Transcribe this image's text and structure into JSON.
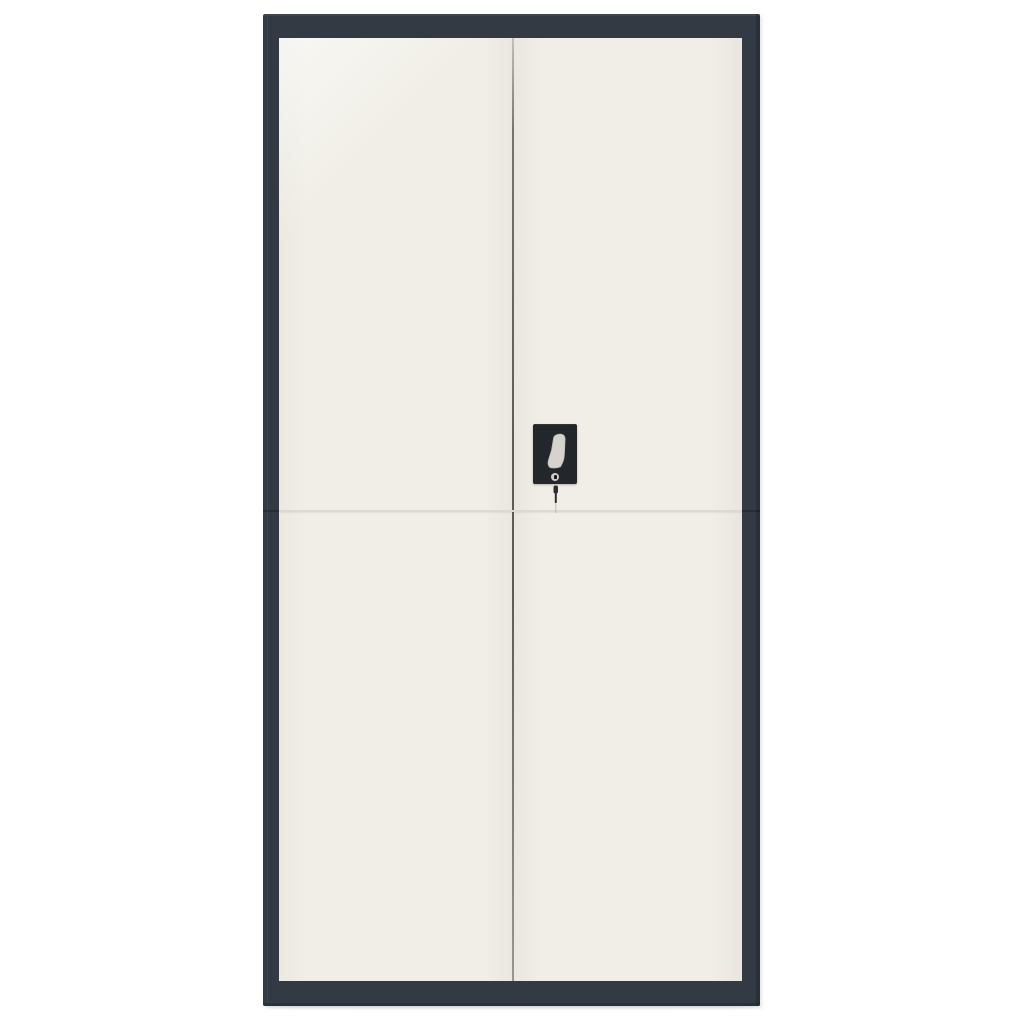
{
  "scene": {
    "subject": "Tall two-door steel file cabinet with anthracite frame, off-white doors, black lock plate with lever handle, keyhole and hanging key",
    "background_color": "#ffffff"
  },
  "colors": {
    "frame": "#333a43",
    "door": "#f0eee6",
    "seam_vertical_base": "#74736e",
    "seam_horizontal": "#dcd9d2",
    "handle_plate": "#23262b",
    "handle_lever": "#d6d3cc",
    "handle_lever_edge": "#bdbab2",
    "keyhole_ring": "#cfccc5",
    "keyhole_slot": "#16181c",
    "key": "#2b2e33",
    "key_cord": "#b4b1aa"
  }
}
